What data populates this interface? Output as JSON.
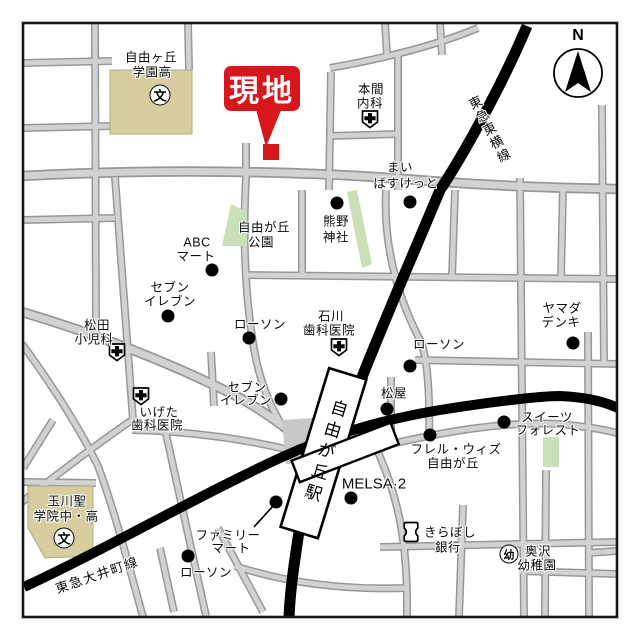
{
  "site_marker": {
    "label": "現地"
  },
  "station": {
    "label": "自由が丘駅"
  },
  "railways": {
    "toyoko": "東急東横線",
    "oimachi": "東急大井町線"
  },
  "compass": {
    "north_label": "N"
  },
  "symbols": {
    "school": "文",
    "kindergarten": "幼"
  },
  "pois": [
    {
      "id": "jiyugaoka-gakuen-high",
      "lines": [
        "自由ヶ丘",
        "学園高"
      ],
      "symbol": "school"
    },
    {
      "id": "homma-naika",
      "lines": [
        "本間",
        "内科"
      ],
      "symbol": "hospital"
    },
    {
      "id": "my-basket",
      "lines": [
        "まい",
        "ばすけっと"
      ],
      "symbol": "dot"
    },
    {
      "id": "kumano-jinja",
      "lines": [
        "熊野",
        "神社"
      ],
      "symbol": "dot"
    },
    {
      "id": "jiyugaoka-park",
      "lines": [
        "自由が丘",
        "公園"
      ],
      "symbol": "park"
    },
    {
      "id": "abc-mart",
      "lines": [
        "ABC",
        "マート"
      ],
      "symbol": "dot"
    },
    {
      "id": "seven-eleven-north",
      "lines": [
        "セブン",
        "イレブン"
      ],
      "symbol": "dot"
    },
    {
      "id": "matsuda-pediatrics",
      "lines": [
        "松田",
        "小児科"
      ],
      "symbol": "hospital"
    },
    {
      "id": "lawson-center",
      "lines": [
        "ローソン"
      ],
      "symbol": "dot"
    },
    {
      "id": "ishikawa-dental",
      "lines": [
        "石川",
        "歯科医院"
      ],
      "symbol": "hospital"
    },
    {
      "id": "yamada-denki",
      "lines": [
        "ヤマダ",
        "デンキ"
      ],
      "symbol": "dot"
    },
    {
      "id": "lawson-east",
      "lines": [
        "ローソン"
      ],
      "symbol": "dot"
    },
    {
      "id": "seven-eleven-south",
      "lines": [
        "セブン",
        "イレブン"
      ],
      "symbol": "dot"
    },
    {
      "id": "igeta-dental",
      "lines": [
        "いげた",
        "歯科医院"
      ],
      "symbol": "hospital"
    },
    {
      "id": "matsuya",
      "lines": [
        "松屋"
      ],
      "symbol": "dot"
    },
    {
      "id": "frelle-with-jiyugaoka",
      "lines": [
        "フレル・ウィズ",
        "自由が丘"
      ],
      "symbol": "dot"
    },
    {
      "id": "melsa-2",
      "lines": [
        "MELSA·2"
      ],
      "symbol": "dot"
    },
    {
      "id": "sweets-forest",
      "lines": [
        "スイーツ",
        "フォレスト"
      ],
      "symbol": "dot"
    },
    {
      "id": "kiraboshi-bank",
      "lines": [
        "きらぼし",
        "銀行"
      ],
      "symbol": "bank"
    },
    {
      "id": "okusawa-kindergarten",
      "lines": [
        "奥沢",
        "幼稚園"
      ],
      "symbol": "kindergarten"
    },
    {
      "id": "tamagawa-seigakuin",
      "lines": [
        "玉川聖",
        "学院中・高"
      ],
      "symbol": "school"
    },
    {
      "id": "family-mart",
      "lines": [
        "ファミリー",
        "マート"
      ],
      "symbol": "dot"
    },
    {
      "id": "lawson-south",
      "lines": [
        "ローソン"
      ],
      "symbol": "dot"
    }
  ],
  "colors": {
    "site_red": "#d7171c",
    "road_fill": "#d2d2d2",
    "road_edge": "#989898",
    "building_beige": "#d7cd9e",
    "park_green": "#c9e0b8",
    "railway_black": "#000000",
    "plaza_gray": "#c8c8c8"
  }
}
